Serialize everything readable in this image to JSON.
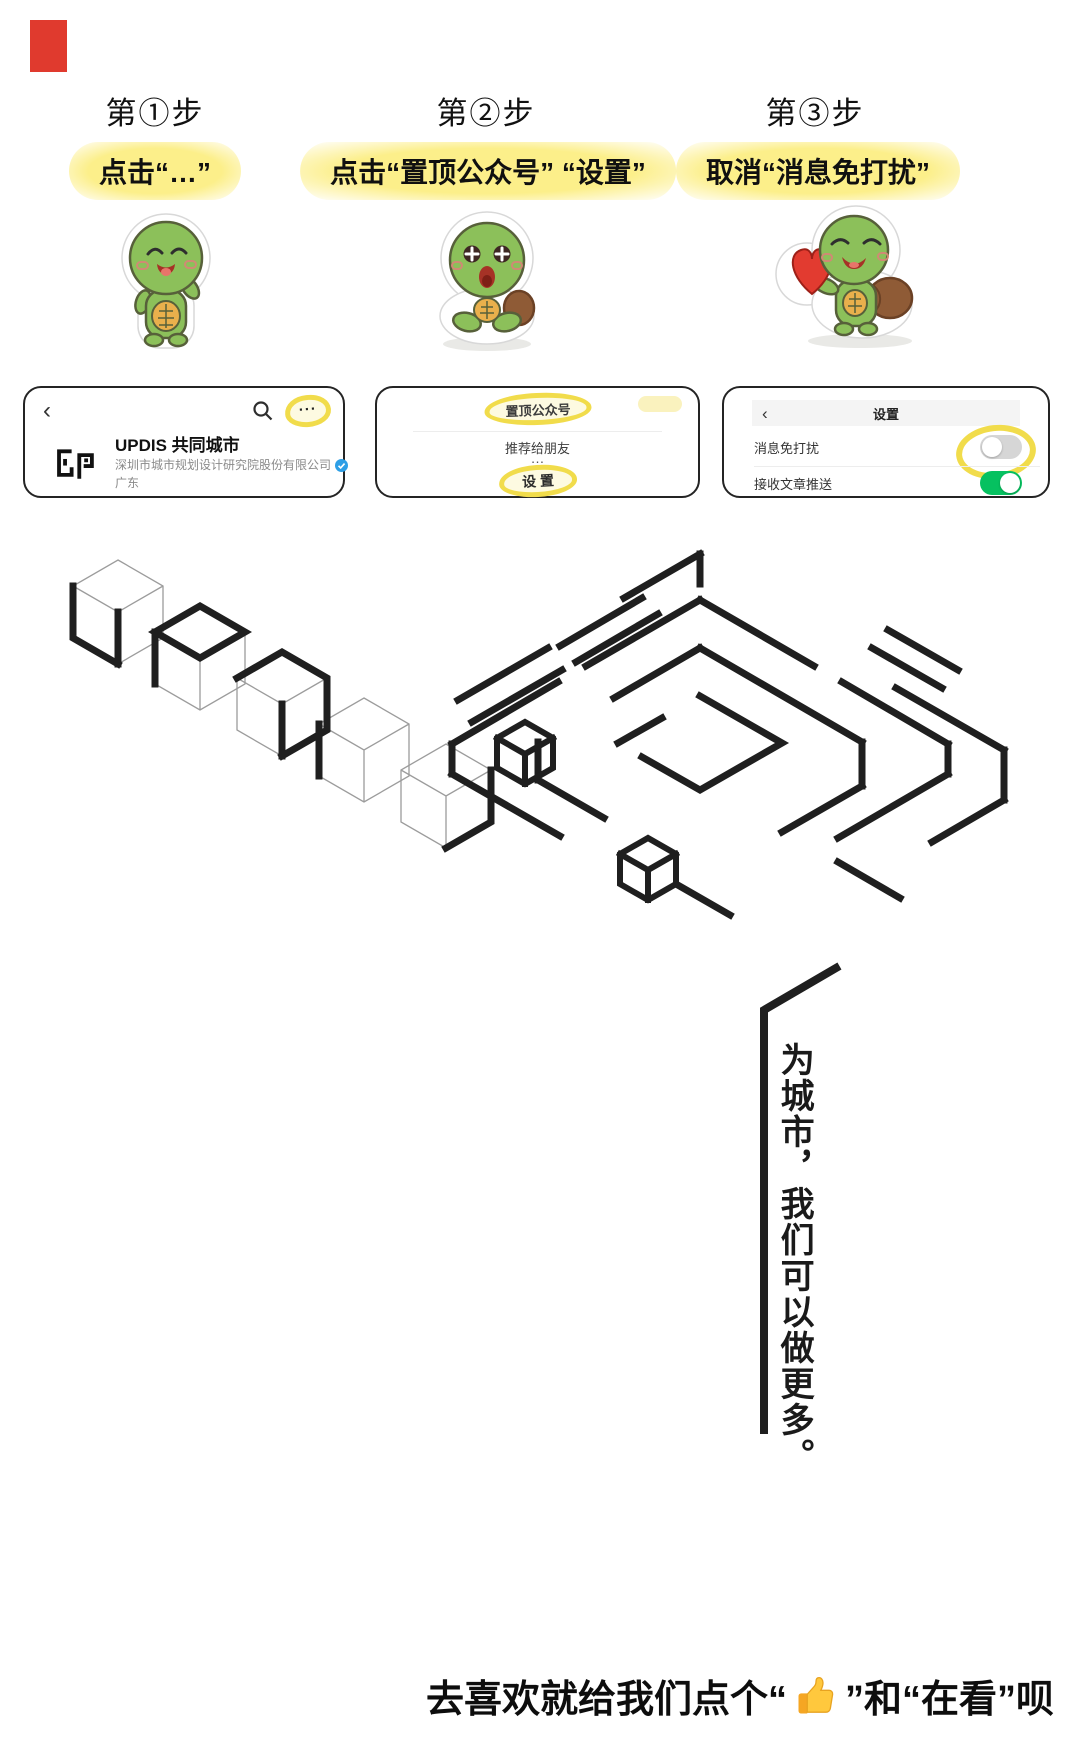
{
  "steps": [
    {
      "title": "第①步",
      "instruction": "点击“…”"
    },
    {
      "title": "第②步",
      "instruction": "点击“置顶公众号” “设置”"
    },
    {
      "title": "第③步",
      "instruction": "取消“消息免打扰”"
    }
  ],
  "profile_card": {
    "back_icon": "‹",
    "more_label": "···",
    "name": "UPDIS 共同城市",
    "company": "深圳市城市规划设计研究院股份有限公司",
    "region": "广东"
  },
  "menu_card": {
    "pin_label": "置顶公众号",
    "recommend_label": "推荐给朋友",
    "ellipsis": "…",
    "settings_label": "设 置"
  },
  "settings_card": {
    "back_icon": "‹",
    "title": "设置",
    "rows": [
      {
        "label": "消息免打扰",
        "state": "off"
      },
      {
        "label": "接收文章推送",
        "state": "on"
      }
    ]
  },
  "artwork": {
    "vertical_slogan": "为城市，我们可以做更多。"
  },
  "footer": {
    "prefix": "去喜欢就给我们点个“",
    "thumb_emoji": "👍",
    "suffix": "”和“在看”呗"
  },
  "colors": {
    "highlight_yellow": "#f1dc4b",
    "toggle_on_green": "#06c160",
    "toggle_off_gray": "#d6d6d6",
    "verified_blue": "#2e9fe6",
    "accent_red": "#e03a2e",
    "ink": "#1f1f1f"
  }
}
